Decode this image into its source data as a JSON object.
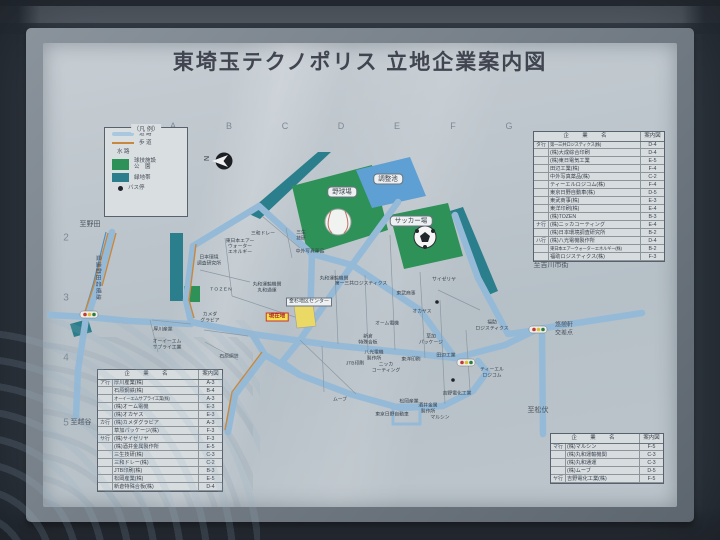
{
  "title": "東埼玉テクノポリス 立地企業案内図",
  "grid": {
    "columns": [
      "A",
      "B",
      "C",
      "D",
      "E",
      "F",
      "G"
    ],
    "rows": [
      "2",
      "3",
      "4",
      "5"
    ]
  },
  "legend": {
    "title": "（凡 例）",
    "items": [
      {
        "name": "road",
        "label": "道 路"
      },
      {
        "name": "sidewalk",
        "label": "歩 道"
      },
      {
        "name": "waterway",
        "label": "水 路"
      },
      {
        "name": "sports-park",
        "label": "球技施設\n公　園"
      },
      {
        "name": "greenbelt",
        "label": "緑地帯"
      },
      {
        "name": "bus-stop",
        "label": "バス停"
      }
    ]
  },
  "compass": {
    "label": "N"
  },
  "colors": {
    "road": "#95bad8",
    "sidewalk": "#c8873c",
    "water": "#4d90c8",
    "park": "#2e9158",
    "greenbelt": "#2b7e8b",
    "pond": "#5e9fd4",
    "current_bg": "#f2e24d",
    "current_border": "#cc3333",
    "table_bg": "#d7dcdf"
  },
  "tables": {
    "col_company": "企　業　名",
    "col_ref": "案内図",
    "top_right": [
      [
        "タ行",
        "第一三共ロジスティクス(株)",
        "D-4"
      ],
      [
        "",
        "(株)大成綜合印刷",
        "D-4"
      ],
      [
        "",
        "(株)東日電気工業",
        "E-5"
      ],
      [
        "",
        "田辺工業(株)",
        "F-4"
      ],
      [
        "",
        "中外写真薬品(株)",
        "C-2"
      ],
      [
        "",
        "ティーエルロジコム(株)",
        "F-4"
      ],
      [
        "",
        "東京日野自動車(株)",
        "D-5"
      ],
      [
        "",
        "東武商事(株)",
        "E-3"
      ],
      [
        "",
        "東洋印刷(株)",
        "E-4"
      ],
      [
        "",
        "(株)TOZEN",
        "B-3"
      ],
      [
        "ナ行",
        "(株)ニッカコーティング",
        "E-4"
      ],
      [
        "",
        "(株)日本環境調査研究所",
        "B-2"
      ],
      [
        "ハ行",
        "(株)八光電機製作所",
        "D-4"
      ],
      [
        "",
        "東日本エアーウォーターエネルギー(株)",
        "B-2"
      ],
      [
        "",
        "福助ロジスティクス(株)",
        "F-3"
      ]
    ],
    "bottom_left": [
      [
        "ア行",
        "厚川産業(株)",
        "A-3"
      ],
      [
        "",
        "石原鋼鉄(株)",
        "B-4"
      ],
      [
        "",
        "オーイーエムサプライ工業(株)",
        "A-3"
      ],
      [
        "",
        "(株)オーム電機",
        "E-3"
      ],
      [
        "",
        "(株)オカヤス",
        "E-3"
      ],
      [
        "カ行",
        "(株)カメダグラビア",
        "A-3"
      ],
      [
        "",
        "草加パッケージ(株)",
        "F-3"
      ],
      [
        "サ行",
        "(株)サイゼリヤ",
        "F-3"
      ],
      [
        "",
        "(株)酒井金属製作所",
        "E-5"
      ],
      [
        "",
        "三生技研(株)",
        "C-3"
      ],
      [
        "",
        "三和ドレー(株)",
        "C-2"
      ],
      [
        "",
        "JTB印刷(株)",
        "B-3"
      ],
      [
        "",
        "松岡産業(株)",
        "E-5"
      ],
      [
        "",
        "新倉特殊合板(株)",
        "D-4"
      ]
    ],
    "bottom_right": [
      [
        "マ行",
        "(株)マルシン",
        "F-5"
      ],
      [
        "",
        "(株)丸和運輸機関",
        "C-3"
      ],
      [
        "",
        "(株)丸和通運",
        "C-3"
      ],
      [
        "",
        "(株)ムーブ",
        "D-5"
      ],
      [
        "ヤ行",
        "吉野電化工業(株)",
        "F-5"
      ]
    ]
  },
  "map": {
    "labels": [
      {
        "t": "野球場",
        "x": 342,
        "y": 192,
        "k": "area"
      },
      {
        "t": "調整池",
        "x": 388,
        "y": 179,
        "k": "area"
      },
      {
        "t": "サッカー場",
        "x": 411,
        "y": 221,
        "k": "area"
      },
      {
        "t": "金杉地区センター",
        "x": 309,
        "y": 302,
        "k": "small"
      },
      {
        "t": "現在地",
        "x": 277,
        "y": 317,
        "k": "current"
      },
      {
        "t": "至野田",
        "x": 90,
        "y": 225,
        "k": "plain"
      },
      {
        "t": "至吉川市街",
        "x": 551,
        "y": 266,
        "k": "plain"
      },
      {
        "t": "至松伏",
        "x": 538,
        "y": 411,
        "k": "plain"
      },
      {
        "t": "至越谷",
        "x": 81,
        "y": 423,
        "k": "plain"
      },
      {
        "t": "悠憩軒\n交差点",
        "x": 564,
        "y": 330,
        "k": "inter"
      },
      {
        "t": "県道野田岩槻線",
        "x": 97,
        "y": 278,
        "k": "road"
      },
      {
        "t": "三和ドレー",
        "x": 263,
        "y": 234,
        "k": "parcel"
      },
      {
        "t": "三生\n技研",
        "x": 301,
        "y": 236,
        "k": "parcel"
      },
      {
        "t": "東日本エアー\nウォーター\nエネルギー",
        "x": 240,
        "y": 247,
        "k": "parcel"
      },
      {
        "t": "日本環境\n調査研究所",
        "x": 209,
        "y": 261,
        "k": "parcel"
      },
      {
        "t": "T O Z E N",
        "x": 221,
        "y": 290,
        "k": "parcel"
      },
      {
        "t": "中外写真薬品",
        "x": 310,
        "y": 252,
        "k": "parcel"
      },
      {
        "t": "丸和運輸機関\n丸和通運",
        "x": 267,
        "y": 288,
        "k": "parcel"
      },
      {
        "t": "丸和運輸機関",
        "x": 334,
        "y": 279,
        "k": "parcel"
      },
      {
        "t": "第一三共ロジスティクス",
        "x": 361,
        "y": 284,
        "k": "parcel"
      },
      {
        "t": "サイゼリヤ",
        "x": 444,
        "y": 280,
        "k": "parcel"
      },
      {
        "t": "東武商事",
        "x": 406,
        "y": 294,
        "k": "parcel"
      },
      {
        "t": "オカヤス",
        "x": 422,
        "y": 312,
        "k": "parcel"
      },
      {
        "t": "オーム電機",
        "x": 387,
        "y": 324,
        "k": "parcel"
      },
      {
        "t": "福助\nロジスティクス",
        "x": 492,
        "y": 326,
        "k": "parcel"
      },
      {
        "t": "草加\nパッケージ",
        "x": 431,
        "y": 340,
        "k": "parcel"
      },
      {
        "t": "新倉\n特殊合板",
        "x": 368,
        "y": 340,
        "k": "parcel"
      },
      {
        "t": "八光電機\n製作所",
        "x": 374,
        "y": 356,
        "k": "parcel"
      },
      {
        "t": "JTB印刷",
        "x": 355,
        "y": 364,
        "k": "parcel"
      },
      {
        "t": "ニッカ\nコーティング",
        "x": 386,
        "y": 368,
        "k": "parcel"
      },
      {
        "t": "東洋印刷",
        "x": 411,
        "y": 360,
        "k": "parcel"
      },
      {
        "t": "田辺工業",
        "x": 446,
        "y": 356,
        "k": "parcel"
      },
      {
        "t": "ティーエル\nロジコム",
        "x": 492,
        "y": 373,
        "k": "parcel"
      },
      {
        "t": "吉野電化工業",
        "x": 457,
        "y": 394,
        "k": "parcel"
      },
      {
        "t": "ムーブ",
        "x": 340,
        "y": 400,
        "k": "parcel"
      },
      {
        "t": "東京日野自動車",
        "x": 392,
        "y": 415,
        "k": "parcel"
      },
      {
        "t": "松岡産業",
        "x": 409,
        "y": 402,
        "k": "parcel"
      },
      {
        "t": "酒井金属\n製作所",
        "x": 428,
        "y": 409,
        "k": "parcel"
      },
      {
        "t": "マルシン",
        "x": 440,
        "y": 418,
        "k": "parcel"
      },
      {
        "t": "カメダ\nグラビア",
        "x": 210,
        "y": 318,
        "k": "parcel"
      },
      {
        "t": "厚川産業",
        "x": 163,
        "y": 330,
        "k": "parcel"
      },
      {
        "t": "オーイーエム\nサプライ工業",
        "x": 167,
        "y": 345,
        "k": "parcel"
      },
      {
        "t": "石原鋼鉄",
        "x": 229,
        "y": 357,
        "k": "parcel"
      }
    ]
  }
}
